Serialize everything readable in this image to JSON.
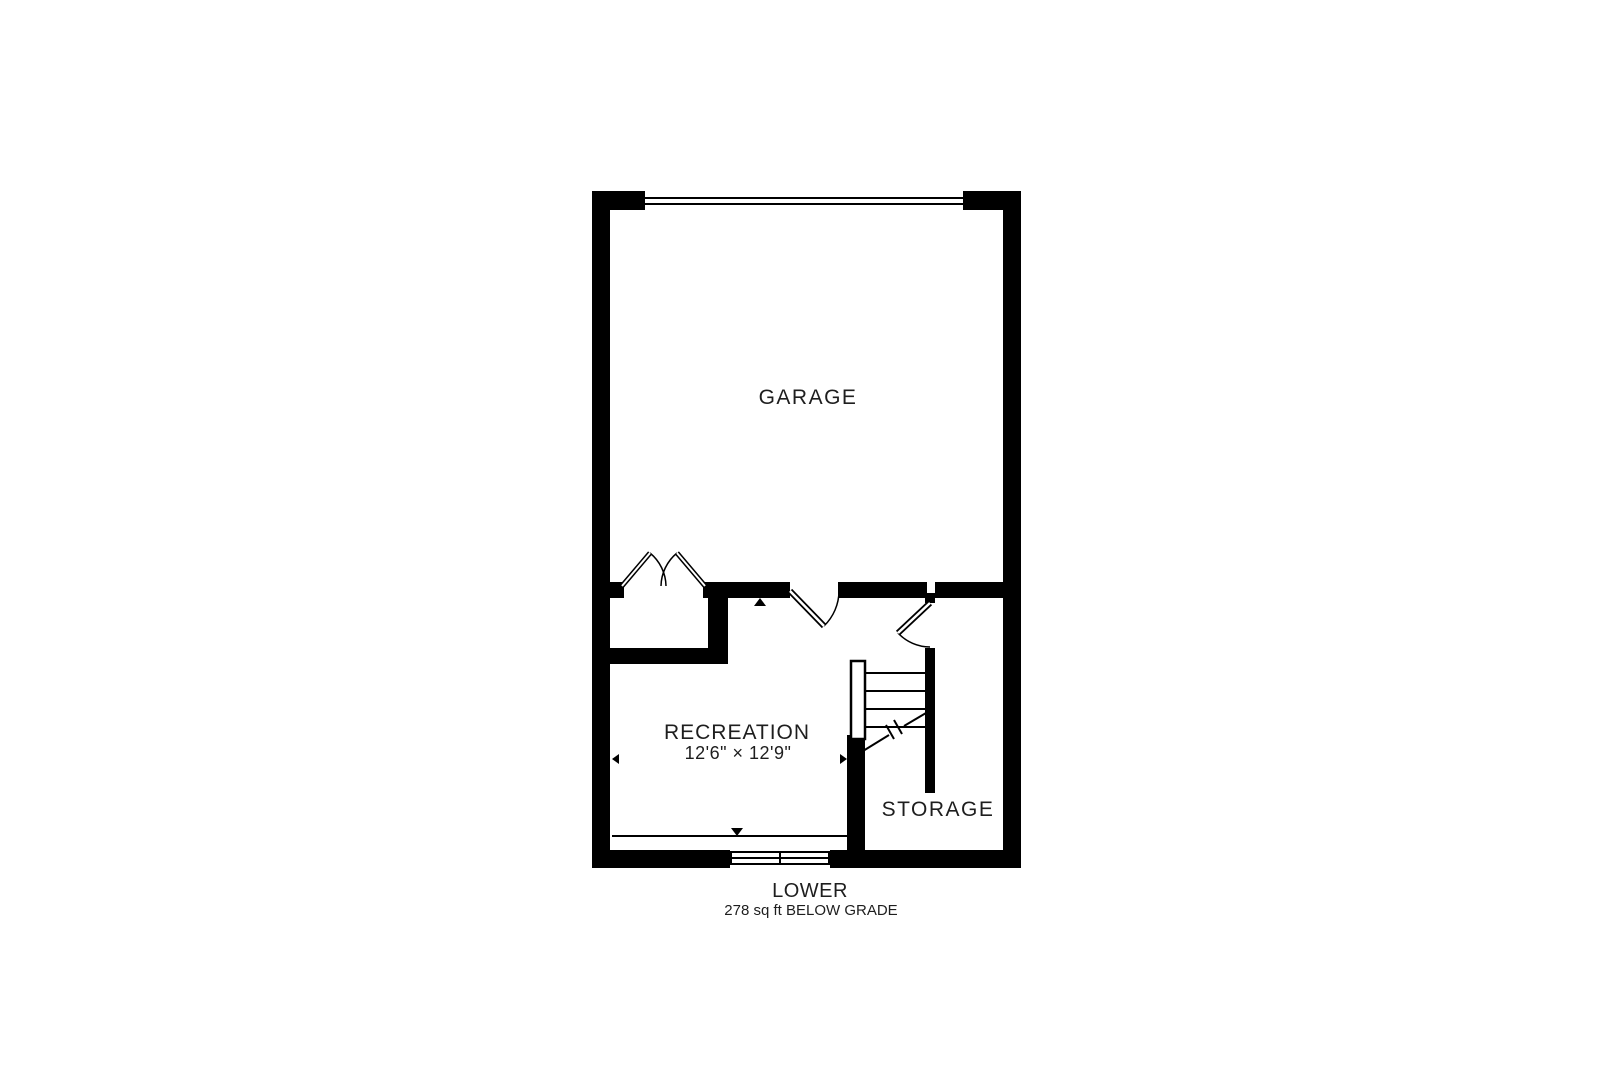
{
  "floorplan": {
    "title": "LOWER",
    "area_note": "278 sq ft BELOW GRADE",
    "rooms": [
      {
        "name": "garage",
        "label": "GARAGE"
      },
      {
        "name": "recreation",
        "label": "RECREATION",
        "dimensions": "12'6\" × 12'9\""
      },
      {
        "name": "storage",
        "label": "STORAGE"
      }
    ],
    "features": [
      "garage-door",
      "bifold-closet-doors",
      "swing-door-garage-to-recreation",
      "swing-door-stairs-to-storage",
      "staircase-up",
      "below-grade-window"
    ],
    "colors": {
      "wall": "#000000",
      "background": "#ffffff",
      "text": "#1e1e1e"
    }
  }
}
